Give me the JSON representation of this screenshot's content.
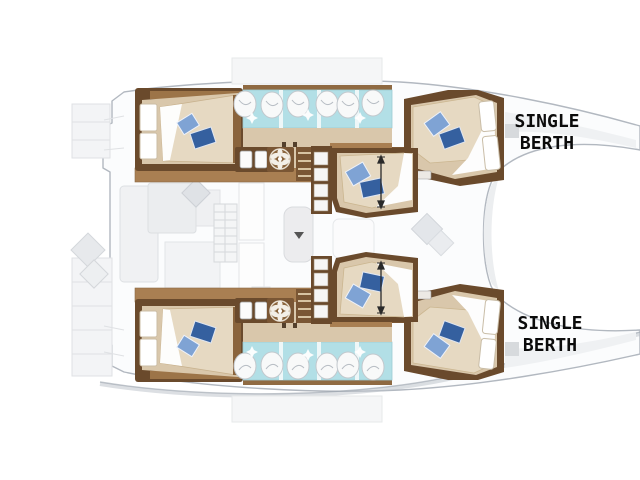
{
  "labels": {
    "single_berth_top": {
      "line1": "SINGLE",
      "line2": "BERTH"
    },
    "single_berth_bottom": {
      "line1": "SINGLE",
      "line2": "BERTH"
    }
  },
  "floorplan": {
    "vessel": "catamaran deck plan, bows at right, sterns at left",
    "double_beds_visible": 6,
    "single_berth_callouts": 2,
    "bathroom_sink_rows": 2,
    "sinks_per_row": 6
  },
  "icons": {
    "sink": "sink-icon",
    "shower_fan": "shower-fan-icon",
    "pillow": "pillow-icon",
    "dimension_arrow": "dimension-arrow-icon",
    "table_arrow": "table-arrow-icon"
  },
  "colors": {
    "wall_brown": "#6a4a2c",
    "wood_trim": "#a97f52",
    "step_wood": "#7a5634",
    "floor_tan": "#d9c7ab",
    "mattress_beige": "#e6d9c2",
    "bathroom_aqua": "#b2dfe6",
    "pillow_light_blue": "#7fa3d4",
    "pillow_dark_blue": "#35609f",
    "hull_outline_gray": "#b2b8c0",
    "faded_deck_gray": "#eceef0",
    "label_text": "#0b0b0b"
  }
}
